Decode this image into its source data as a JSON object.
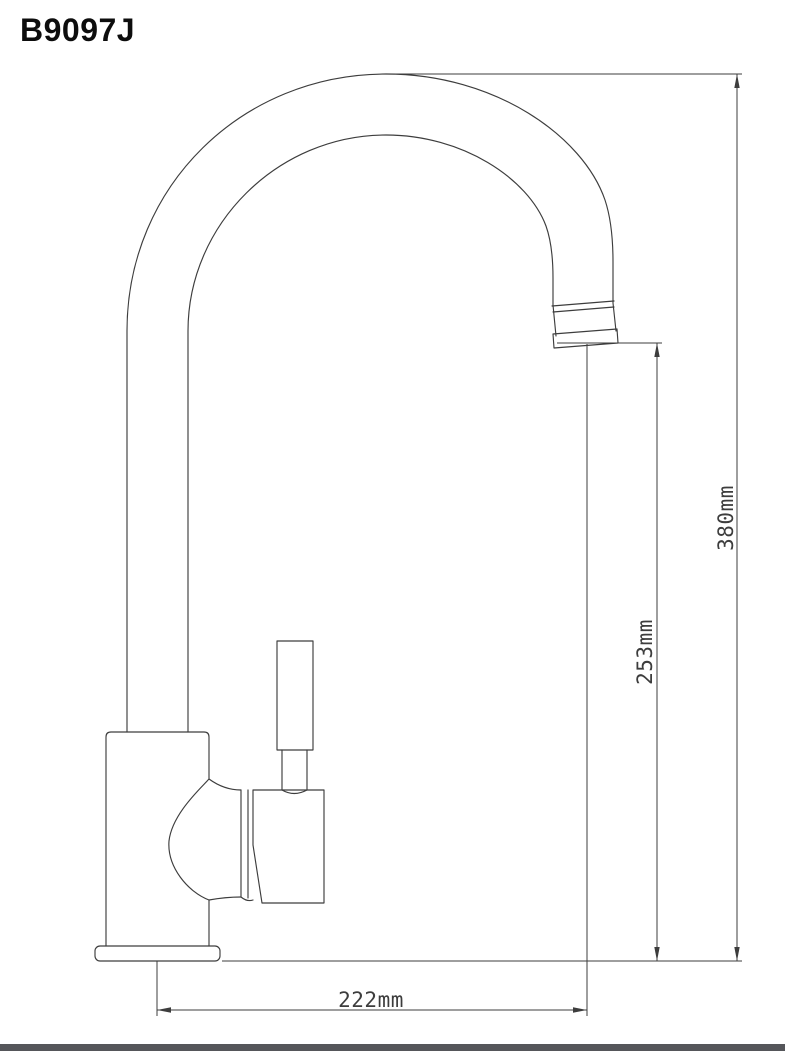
{
  "title": "B9097J",
  "dimensions": {
    "total_height": "380mm",
    "spout_outlet_height": "253mm",
    "spout_reach": "222mm"
  },
  "colors": {
    "line": "#3d3d3d",
    "title_text": "#0d0d0d",
    "footer_bar": "#55565a",
    "background": "#ffffff"
  }
}
